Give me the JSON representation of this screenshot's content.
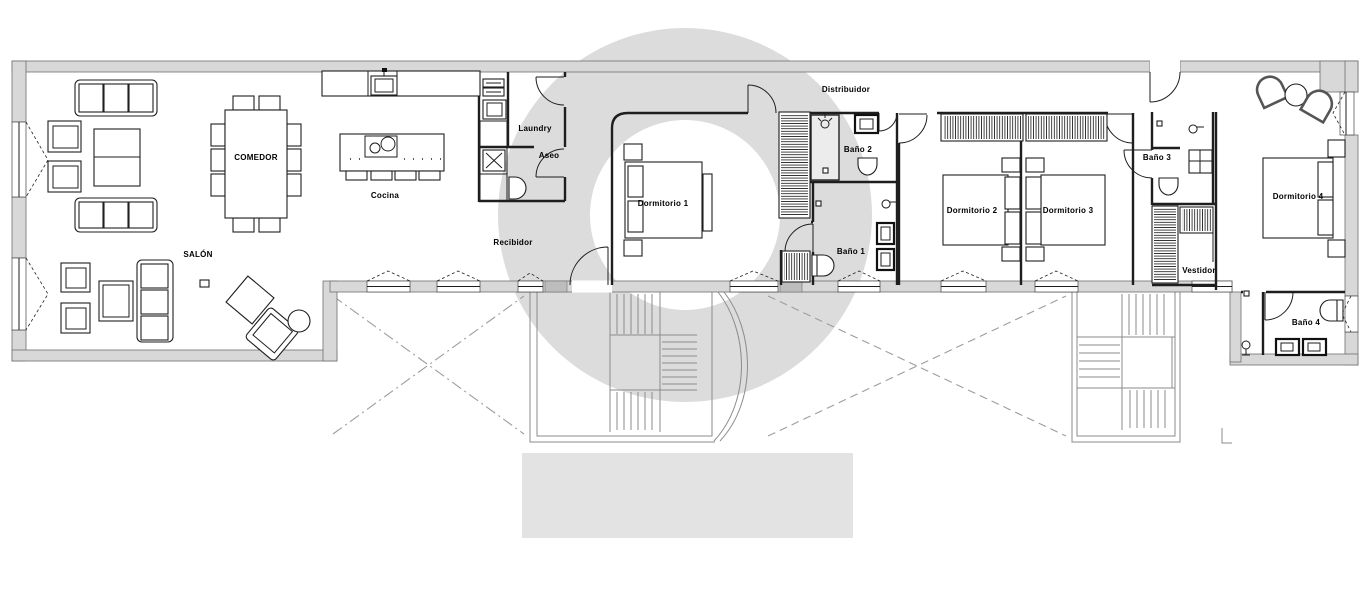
{
  "plan": {
    "type": "architectural-floor-plan",
    "language": "Spanish",
    "labels": [
      {
        "id": "comedor",
        "label": "COMEDOR",
        "x": 256,
        "y": 160
      },
      {
        "id": "cocina",
        "label": "Cocina",
        "x": 385,
        "y": 198
      },
      {
        "id": "salon",
        "label": "SALÓN",
        "x": 198,
        "y": 257
      },
      {
        "id": "laundry",
        "label": "Laundry",
        "x": 535,
        "y": 131
      },
      {
        "id": "aseo",
        "label": "Aseo",
        "x": 549,
        "y": 158
      },
      {
        "id": "recibidor",
        "label": "Recibidor",
        "x": 513,
        "y": 245
      },
      {
        "id": "dormitorio-1",
        "label": "Dormitorio 1",
        "x": 663,
        "y": 206
      },
      {
        "id": "bano-2",
        "label": "Baño 2",
        "x": 858,
        "y": 152
      },
      {
        "id": "bano-1",
        "label": "Baño 1",
        "x": 851,
        "y": 254
      },
      {
        "id": "distribuidor",
        "label": "Distribuidor",
        "x": 846,
        "y": 92
      },
      {
        "id": "dormitorio-2",
        "label": "Dormitorio 2",
        "x": 972,
        "y": 213
      },
      {
        "id": "dormitorio-3",
        "label": "Dormitorio 3",
        "x": 1068,
        "y": 213
      },
      {
        "id": "bano-3",
        "label": "Baño 3",
        "x": 1157,
        "y": 160
      },
      {
        "id": "vestidor",
        "label": "Vestidor",
        "x": 1199,
        "y": 273
      },
      {
        "id": "dormitorio-4",
        "label": "Dormitorio 4",
        "x": 1298,
        "y": 199
      },
      {
        "id": "bano-4",
        "label": "Baño 4",
        "x": 1306,
        "y": 325
      }
    ]
  },
  "watermark": {
    "ring_color": "#dcdcdc",
    "block_color": "#e3e3e3"
  },
  "colors": {
    "wall_fill": "#d8d8d8",
    "wall_stroke": "#6f6f6f",
    "line": "#1e1e1e",
    "stair": "#8b8b8b",
    "dash": "#9d9d9d",
    "label": "#000000",
    "background": "#ffffff"
  }
}
